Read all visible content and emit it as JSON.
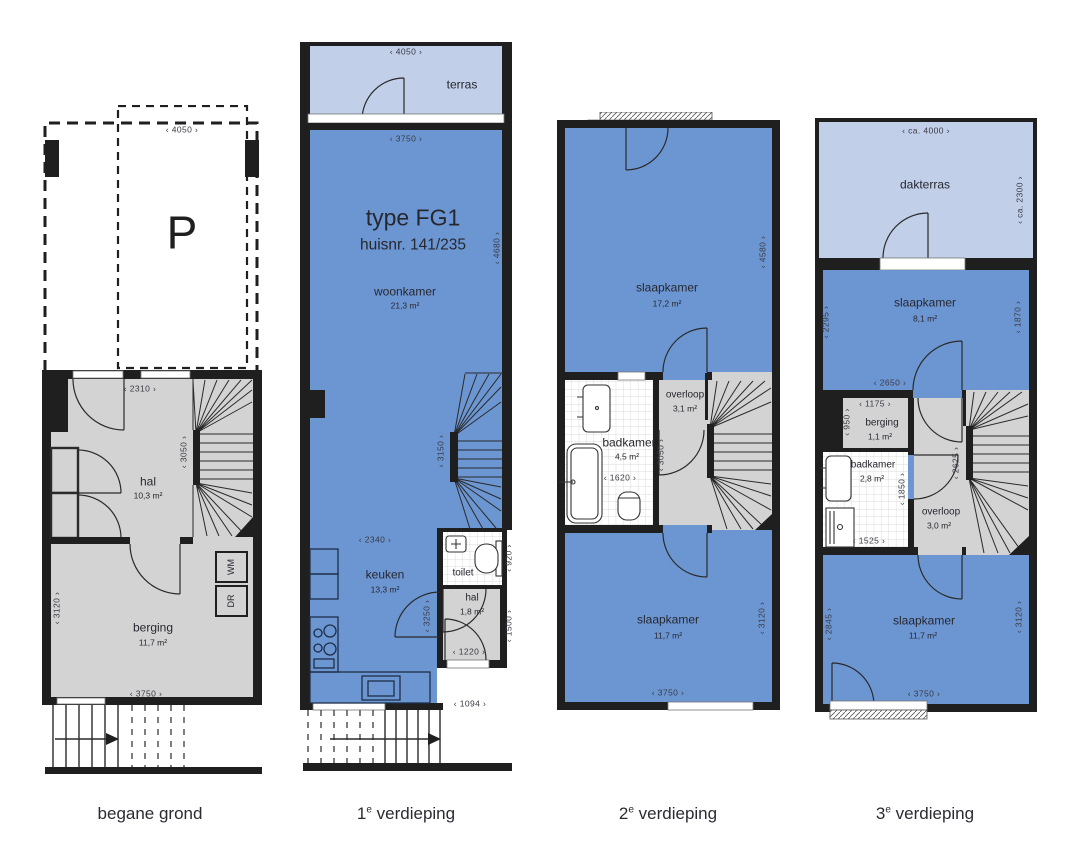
{
  "palette": {
    "wall": "#1f1f1f",
    "room_blue": "#6c96d2",
    "terrace_blue": "#c1cfe9",
    "room_gray": "#d3d3d3",
    "line": "#2a2a2a"
  },
  "floors": [
    {
      "label_prefix": "begane grond",
      "label_sup": "",
      "label_suffix": "",
      "texts": {
        "dim_parking": "‹ 4050 ›",
        "parking": "P",
        "dim_hal": "‹ 2310 ›",
        "dim_stairs": "‹ 3050 ›",
        "hal": "hal",
        "hal_area": "10,3 m²",
        "wm": "WM",
        "dr": "DR",
        "berging": "berging",
        "berging_area": "11,7 m²",
        "dim_left": "‹ 3120 ›",
        "dim_bottom": "‹ 3750 ›"
      }
    },
    {
      "label_prefix": "1",
      "label_sup": "e",
      "label_suffix": " verdieping",
      "texts": {
        "terras": "terras",
        "dim_terras": "‹ 4050 ›",
        "dim_top": "‹ 3750 ›",
        "type": "type FG1",
        "huisnr": "huisnr. 141/235",
        "woonkamer": "woonkamer",
        "woonkamer_area": "21,3 m²",
        "dim_right": "‹ 4680 ›",
        "dim_stairs": "‹ 3150 ›",
        "dim_keuken_w": "‹ 2340 ›",
        "keuken": "keuken",
        "keuken_area": "13,3 m²",
        "dim_keuken_h": "‹ 3250 ›",
        "toilet": "toilet",
        "dim_toilet": "‹ 920 ›",
        "hal": "hal",
        "hal_area": "1,8 m²",
        "dim_hal_h": "‹ 1500 ›",
        "dim_hal_w": "‹ 1220 ›",
        "dim_entry": "‹ 1094 ›"
      }
    },
    {
      "label_prefix": "2",
      "label_sup": "e",
      "label_suffix": " verdieping",
      "texts": {
        "slaapkamer1": "slaapkamer",
        "slaapkamer1_area": "17,2 m²",
        "dim_right_top": "‹ 4580 ›",
        "overloop": "overloop",
        "overloop_area": "3,1 m²",
        "badkamer": "badkamer",
        "badkamer_area": "4,5 m²",
        "dim_badkamer": "‹ 1620 ›",
        "dim_mid": "‹ 3050 ›",
        "slaapkamer2": "slaapkamer",
        "slaapkamer2_area": "11,7 m²",
        "dim_right_bottom": "‹ 3120 ›",
        "dim_bottom": "‹ 3750 ›"
      }
    },
    {
      "label_prefix": "3",
      "label_sup": "e",
      "label_suffix": " verdieping",
      "texts": {
        "dakterras": "dakterras",
        "dim_terras_w": "‹ ca. 4000 ›",
        "dim_terras_h": "‹ ca. 2300 ›",
        "slaapkamer1": "slaapkamer",
        "slaapkamer1_area": "8,1 m²",
        "dim_left_top": "‹ 2295 ›",
        "dim_right_top": "‹ 1870 ›",
        "dim_slk1": "‹ 2650 ›",
        "berging": "berging",
        "berging_area": "1,1 m²",
        "dim_berging_w": "‹ 1175 ›",
        "dim_berging_h": "‹ 950 ›",
        "badkamer": "badkamer",
        "badkamer_area": "2,8 m²",
        "dim_badkamer_h": "‹ 1850 ›",
        "dim_badkamer_w": "‹ 1525 ›",
        "overloop": "overloop",
        "overloop_area": "3,0 m²",
        "dim_overloop": "‹ 2625 ›",
        "slaapkamer2": "slaapkamer",
        "slaapkamer2_area": "11,7 m²",
        "dim_left_bottom": "‹ 2845 ›",
        "dim_right_bottom": "‹ 3120 ›",
        "dim_bottom": "‹ 3750 ›"
      }
    }
  ]
}
